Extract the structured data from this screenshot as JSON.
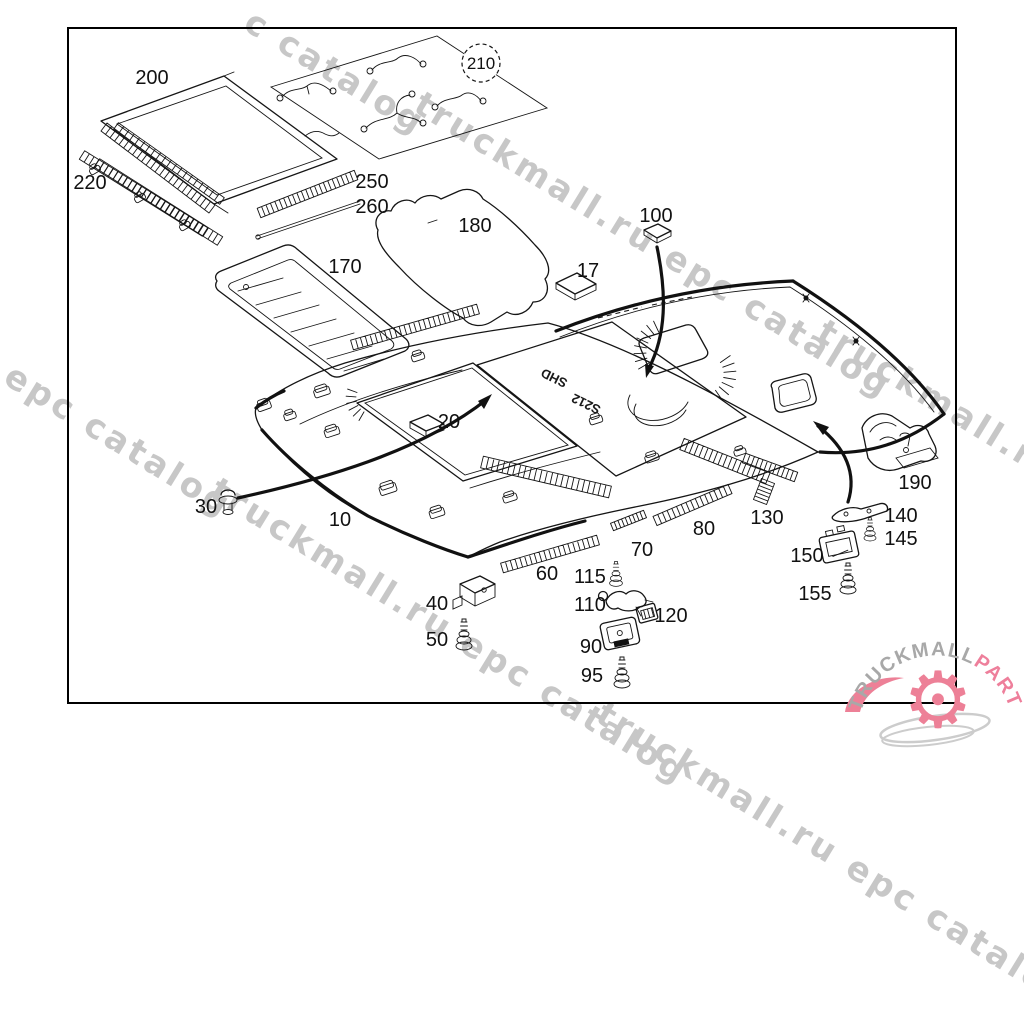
{
  "watermark": {
    "color": "#c7c7c7",
    "instances": [
      {
        "text": "c catalog",
        "x": 258,
        "y": 2
      },
      {
        "text": "truckmall.ru epc catalog",
        "x": 428,
        "y": 84
      },
      {
        "text": "l epc catalog",
        "x": -8,
        "y": 340
      },
      {
        "text": "truckmall.ru epc catalog",
        "x": 224,
        "y": 470
      },
      {
        "text": "truckmall.ru epc catalog",
        "x": 831,
        "y": 312
      },
      {
        "text": "truckmall.ru epc catalog",
        "x": 610,
        "y": 694
      }
    ]
  },
  "diagram": {
    "part_labels": [
      {
        "text": "200",
        "x": 152,
        "y": 84
      },
      {
        "text": "220",
        "x": 90,
        "y": 189
      },
      {
        "text": "250",
        "x": 372,
        "y": 188
      },
      {
        "text": "260",
        "x": 372,
        "y": 213
      },
      {
        "text": "170",
        "x": 345,
        "y": 273
      },
      {
        "text": "180",
        "x": 475,
        "y": 232
      },
      {
        "text": "17",
        "x": 588,
        "y": 277
      },
      {
        "text": "100",
        "x": 656,
        "y": 222
      },
      {
        "text": "20",
        "x": 449,
        "y": 428
      },
      {
        "text": "30",
        "x": 206,
        "y": 513
      },
      {
        "text": "10",
        "x": 340,
        "y": 526
      },
      {
        "text": "40",
        "x": 437,
        "y": 610
      },
      {
        "text": "50",
        "x": 437,
        "y": 646
      },
      {
        "text": "60",
        "x": 547,
        "y": 580
      },
      {
        "text": "70",
        "x": 642,
        "y": 556
      },
      {
        "text": "80",
        "x": 704,
        "y": 535
      },
      {
        "text": "115",
        "x": 590,
        "y": 583
      },
      {
        "text": "110",
        "x": 590,
        "y": 611
      },
      {
        "text": "120",
        "x": 671,
        "y": 622
      },
      {
        "text": "90",
        "x": 591,
        "y": 653
      },
      {
        "text": "95",
        "x": 592,
        "y": 682
      },
      {
        "text": "130",
        "x": 767,
        "y": 524
      },
      {
        "text": "150",
        "x": 807,
        "y": 562
      },
      {
        "text": "155",
        "x": 815,
        "y": 600
      },
      {
        "text": "140",
        "x": 901,
        "y": 522
      },
      {
        "text": "145",
        "x": 901,
        "y": 545
      },
      {
        "text": "190",
        "x": 915,
        "y": 489
      }
    ],
    "circled_label": {
      "text": "210",
      "x": 481,
      "y": 63,
      "r": 19
    },
    "surface_marks": [
      {
        "text": "SHD",
        "x": 556,
        "y": 374,
        "rotate": 206
      },
      {
        "text": "S212",
        "x": 588,
        "y": 400,
        "rotate": 206
      }
    ]
  },
  "logo": {
    "part1": "TRUCKMALL",
    "part2": "PARTS",
    "part1_color": "#a8a8a8",
    "part2_color": "#ee7f9b",
    "gear_color": "#ed8097",
    "swoosh_color": "#cccccc",
    "gear_glyph": "⚙"
  }
}
